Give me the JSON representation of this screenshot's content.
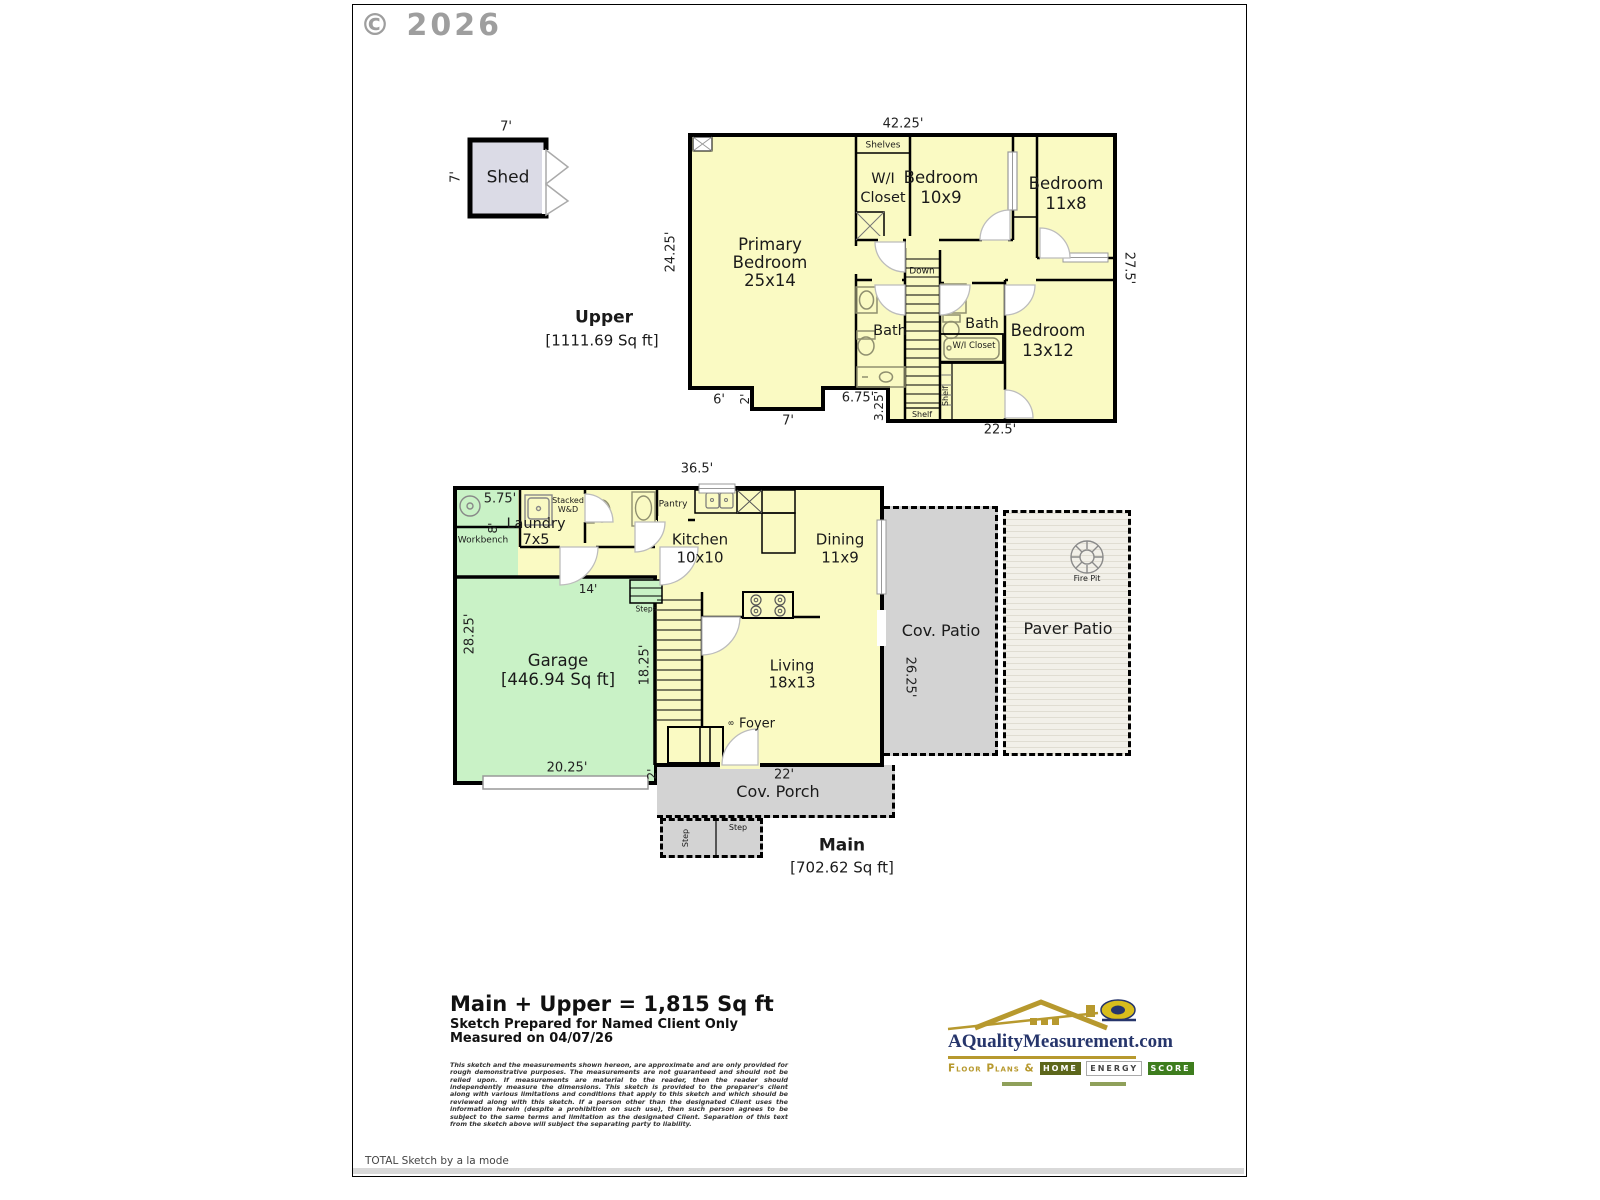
{
  "page": {
    "copyright": "© 2026",
    "brand_footer": "TOTAL Sketch by a la mode"
  },
  "shed": {
    "label": "Shed",
    "dim_top": "7'",
    "dim_side": "7'"
  },
  "upper": {
    "title": "Upper",
    "sqft": "[1111.69 Sq ft]",
    "dim_top": "42.25'",
    "dim_left": "24.25'",
    "dim_right": "27.5'",
    "dim_b6": "6'",
    "dim_b2": "2'",
    "dim_b7": "7'",
    "dim_b675": "6.75'",
    "dim_b325": "3.25'",
    "dim_b225": "22.5'",
    "primary_1": "Primary",
    "primary_2": "Bedroom",
    "primary_3": "25x14",
    "wic_1": "W/I",
    "wic_2": "Closet",
    "shelves": "Shelves",
    "bed10_1": "Bedroom",
    "bed10_2": "10x9",
    "bed11_1": "Bedroom",
    "bed11_2": "11x8",
    "bed13_1": "Bedroom",
    "bed13_2": "13x12",
    "down": "Down",
    "bath_left": "Bath",
    "bath_right": "Bath",
    "wic_small": "W/I Closet",
    "shelf_side": "Shelf",
    "shelf_bottom": "Shelf"
  },
  "main": {
    "title": "Main",
    "sqft": "[702.62 Sq ft]",
    "dim_top": "36.5'",
    "dim_575": "5.75'",
    "dim_8": "8'",
    "workbench": "Workbench",
    "laundry_1": "Laundry",
    "laundry_2": "7x5",
    "stacked_1": "Stacked",
    "stacked_2": "W&D",
    "pantry": "Pantry",
    "kitchen_1": "Kitchen",
    "kitchen_2": "10x10",
    "dining_1": "Dining",
    "dining_2": "11x9",
    "dim_14": "14'",
    "steps": "Steps",
    "dim_2825": "28.25'",
    "dim_1825": "18.25'",
    "garage_1": "Garage",
    "garage_2": "[446.94 Sq ft]",
    "living_1": "Living",
    "living_2": "18x13",
    "foyer": "Foyer",
    "foyer_closet": "8",
    "dim_2025": "20.25'",
    "dim_2": "2'",
    "porch_dim": "22'",
    "porch": "Cov. Porch",
    "step_a": "Step",
    "step_b": "Step",
    "cov_patio": "Cov. Patio",
    "dim_2625": "26.25'",
    "paver_patio": "Paver Patio",
    "fire_pit": "Fire Pit"
  },
  "footer": {
    "total": "Main + Upper = 1,815 Sq ft",
    "prepared": "Sketch Prepared for Named Client Only",
    "measured": "Measured on 04/07/26",
    "disclaimer": "This sketch and the measurements shown hereon, are approximate and are only provided for rough demonstrative purposes. The measurements are not guaranteed and should not be relied upon. If measurements are material to the reader, then the reader should independently measure the dimensions. This sketch is provided to the preparer's client along with various limitations and conditions that apply to this sketch and which should be reviewed along with this sketch. If a person other than the designated Client uses the information herein (despite a prohibition on such use), then such person agrees to be subject to the same terms and limitation as the designated Client. Separation of this text from the sketch above will subject the separating party to liability."
  },
  "logo": {
    "site": "AQualityMeasurement.com",
    "tagline": "Floor Plans &",
    "home": "HOME",
    "energy": "ENERGY",
    "score": "SCORE"
  },
  "palette": {
    "room_yellow": "#FAFAC3",
    "garage_green": "#C9F2C6",
    "shed_gray": "#DBDBE6",
    "patio_gray": "#D3D3D3",
    "paver_bg": "#F2F0E9",
    "wall": "#000000",
    "logo_navy": "#26356B",
    "logo_gold": "#B7992E",
    "score_green": "#3E7D1E"
  }
}
